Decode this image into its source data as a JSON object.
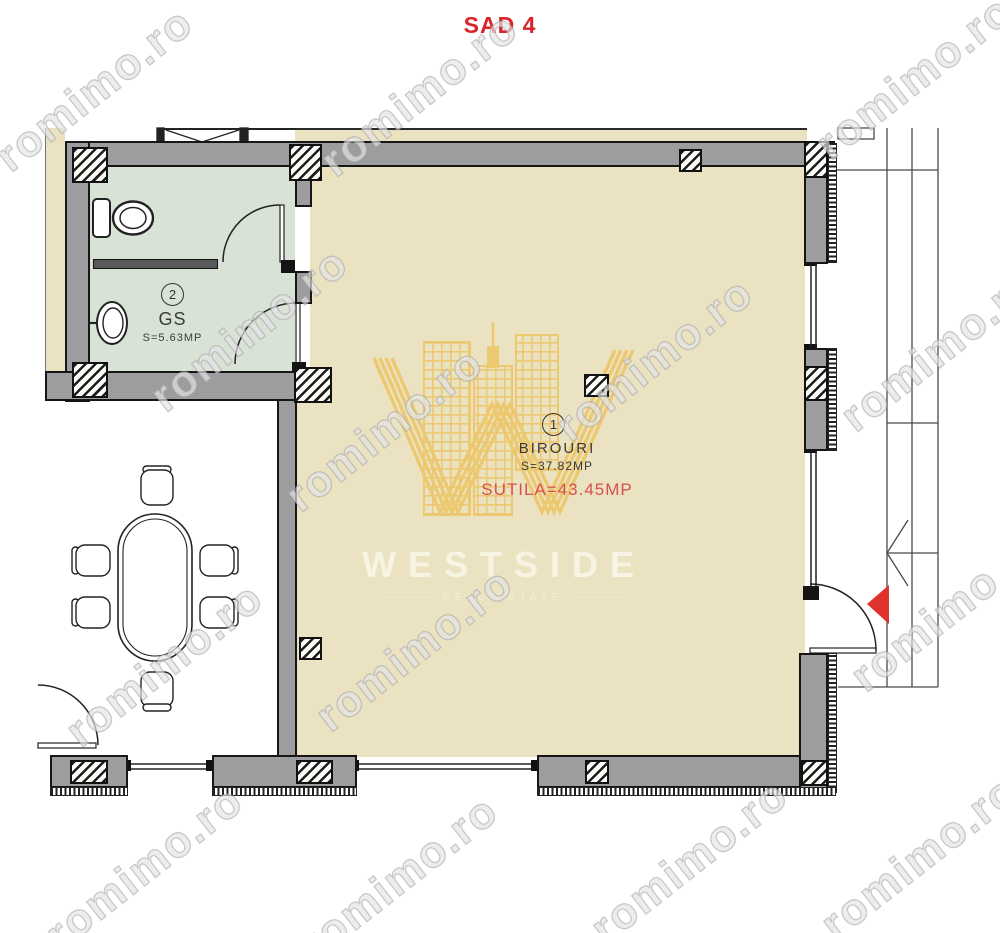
{
  "title": "SAD 4",
  "watermark": {
    "text": "romimo.ro"
  },
  "logo": {
    "wordmark": "WESTSIDE",
    "tagline": "REAL ESTATE"
  },
  "rooms": {
    "bathroom": {
      "number": "2",
      "name": "GS",
      "area": "S=5.63MP"
    },
    "office": {
      "number": "1",
      "name": "BIROURI",
      "area": "S=37.82MP",
      "usable_area": "SUTILA=43.45MP"
    }
  },
  "colors": {
    "title_red": "#d8232a",
    "usable_area_red": "#d94f4f",
    "floor_cream": "#ebe2c1",
    "bathroom_green": "#d8e2d5",
    "wall_gray": "#9d9da0",
    "logo_gold": "#edc45f",
    "entrance_triangle_red": "#e0332c"
  }
}
